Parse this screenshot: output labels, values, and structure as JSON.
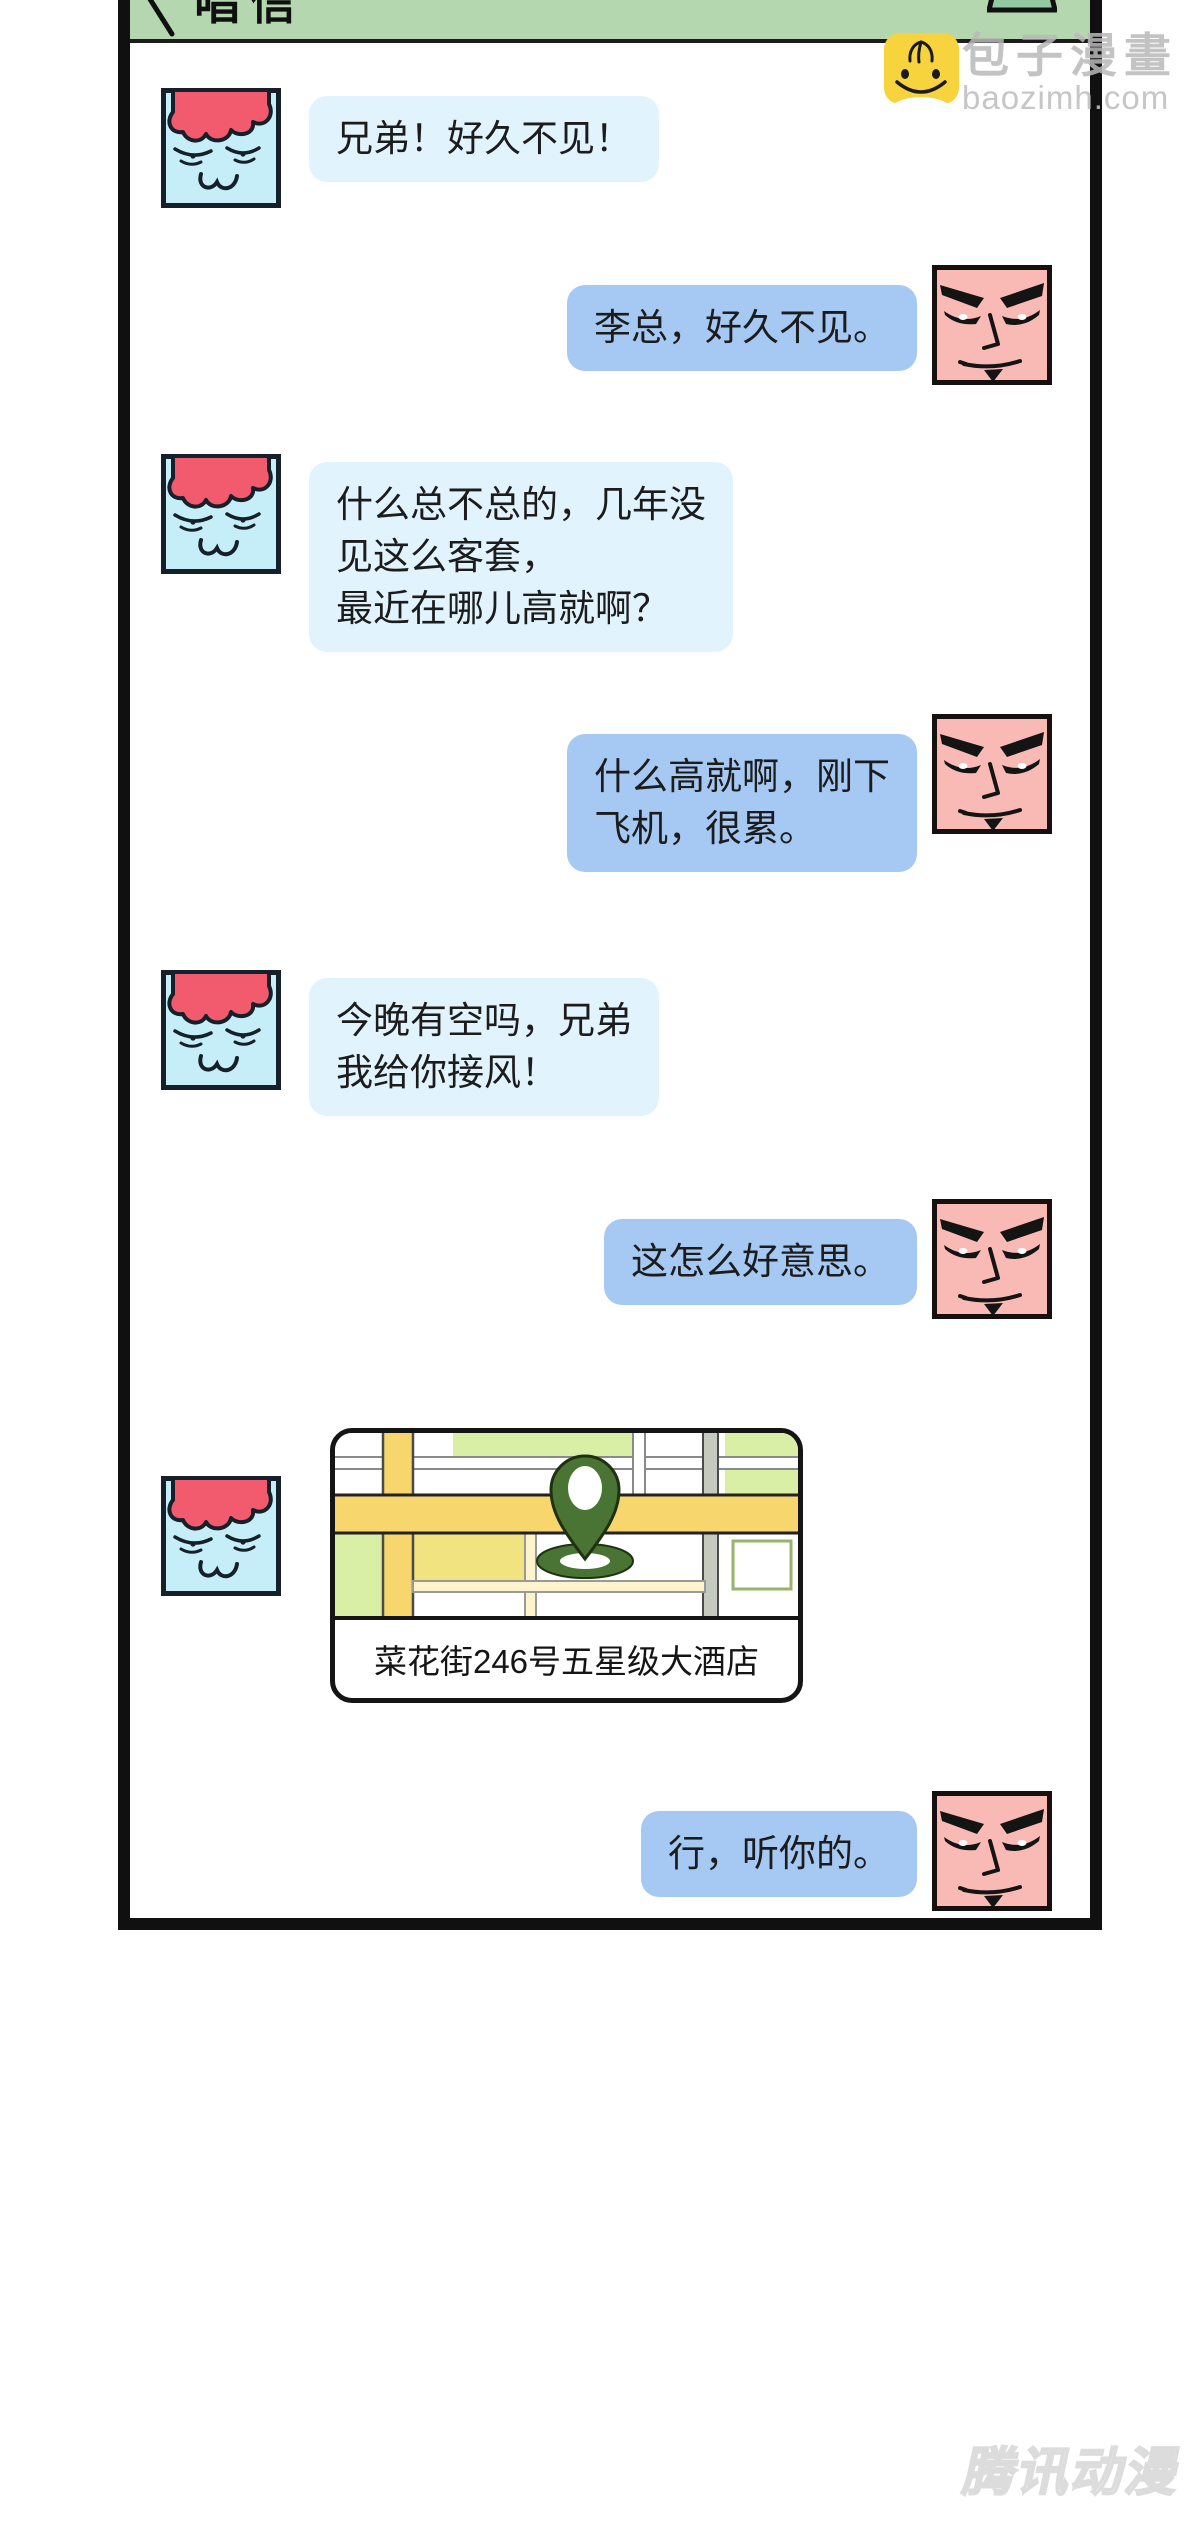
{
  "header": {
    "title": "唱信"
  },
  "conversation": {
    "messages": [
      {
        "side": "left",
        "sender": "li",
        "text": "兄弟！好久不见！"
      },
      {
        "side": "right",
        "sender": "wang",
        "text": "李总，好久不见。"
      },
      {
        "side": "left",
        "sender": "li",
        "text": "什么总不总的，几年没\n见这么客套，\n最近在哪儿高就啊？"
      },
      {
        "side": "right",
        "sender": "wang",
        "text": "什么高就啊，刚下\n飞机，很累。"
      },
      {
        "side": "left",
        "sender": "li",
        "text": "今晚有空吗，兄弟\n我给你接风！"
      },
      {
        "side": "right",
        "sender": "wang",
        "text": "这怎么好意思。"
      },
      {
        "side": "left",
        "sender": "li",
        "type": "location",
        "caption": "菜花街246号五星级大酒店"
      },
      {
        "side": "right",
        "sender": "wang",
        "text": "行，听你的。"
      }
    ]
  },
  "watermarks": {
    "baozi_brand": "包子漫畫",
    "baozi_url": "baozimh.com",
    "tencent": "腾讯动漫"
  },
  "colors": {
    "header_green": "#b5d7b0",
    "bubble_left": "#e1f3fc",
    "bubble_right": "#a6c9f4",
    "face_left": "#c6eef8",
    "face_right": "#f9bab6",
    "hair_red": "#f25a6e",
    "pin_green": "#4a7433",
    "watermark_yellow": "#f7d33e"
  }
}
